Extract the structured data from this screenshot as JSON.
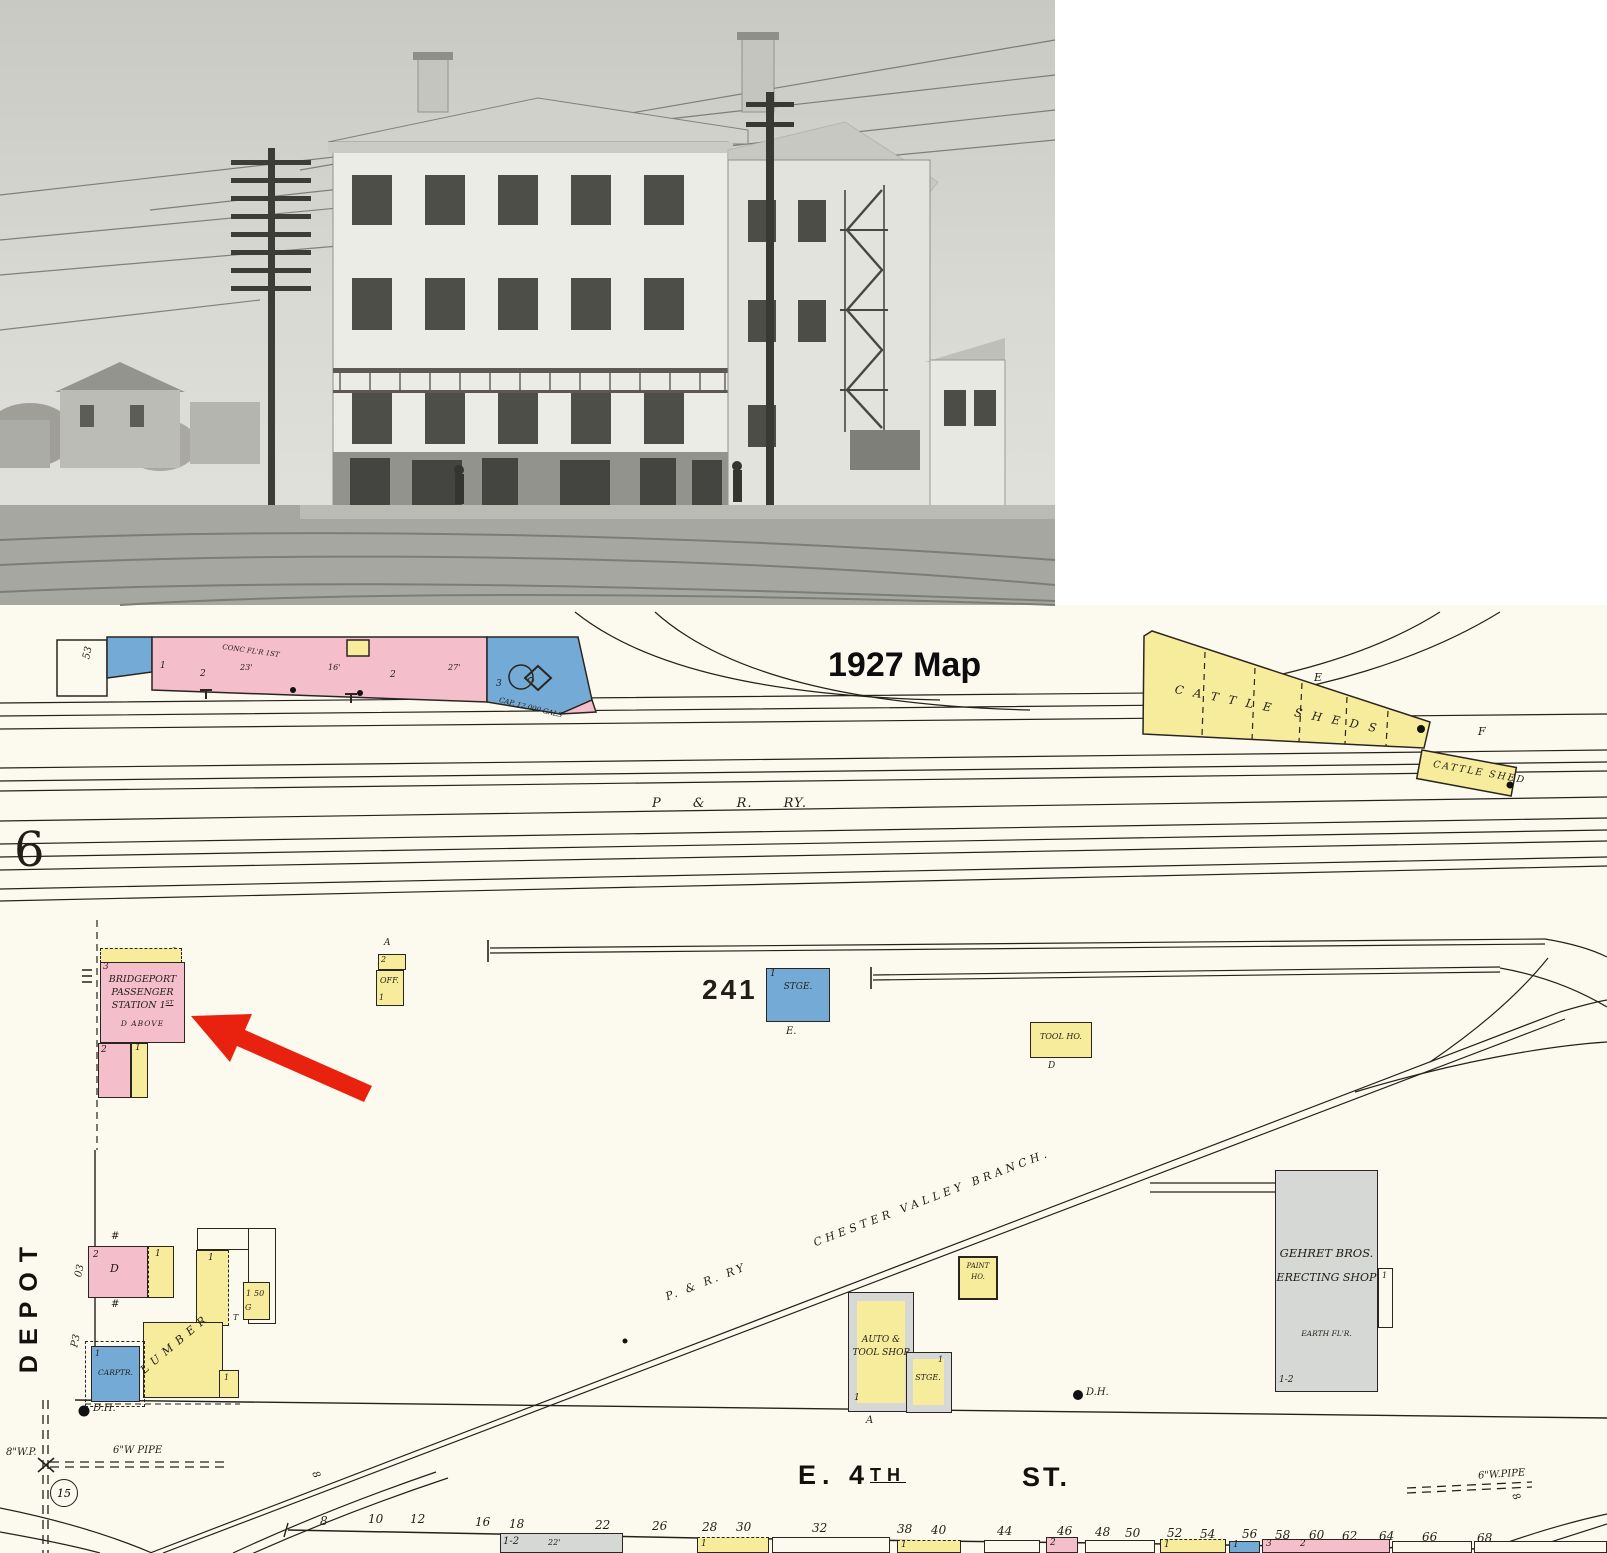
{
  "title": "1927 Map",
  "page_no": "6",
  "yard": {
    "main_line": "P & R. RY."
  },
  "branch": {
    "prefix": "P. & R. RY",
    "name": "CHESTER VALLEY BRANCH."
  },
  "cattle": {
    "big": "CATTLE SHEDS.",
    "e": "E",
    "small": "CATTLE SHED",
    "f": "F"
  },
  "strip": {
    "no53": "53",
    "n1": "1",
    "conc": "CONC FL'R 1ST",
    "w23": "23'",
    "sw1": "2",
    "w16": "16'",
    "sw2": "2",
    "w27": "27'",
    "n3": "3",
    "tank": "CAP. 12,000 GALS"
  },
  "station": {
    "no3": "3",
    "l1": "BRIDGEPORT",
    "l2": "PASSENGER",
    "l3": "STATION 1",
    "l3sup": "ST",
    "l4": "D ABOVE",
    "no2": "2",
    "no1": "1"
  },
  "office": {
    "a": "A",
    "n2": "2",
    "label": "OFF.",
    "n1": "1"
  },
  "lot241": "241",
  "stge": {
    "n1": "1",
    "label": "STGE.",
    "e": "E."
  },
  "toolho": {
    "label": "TOOL HO.",
    "d": "D"
  },
  "paintho": {
    "l1": "PAINT",
    "l2": "HO."
  },
  "gehret": {
    "l1": "GEHRET BROS.",
    "l2": "ERECTING SHOP",
    "l3": "EARTH FL'R.",
    "annex_n": "1",
    "floors": "1-2"
  },
  "autoshop": {
    "l1": "AUTO &",
    "l2": "TOOL SHOP",
    "n1": "1",
    "stge_label": "STGE.",
    "stge_n": "1",
    "a": "A"
  },
  "depot": {
    "street": "DEPOT",
    "no03": "03",
    "noP3": "P3",
    "d_floors": "2",
    "d": "D",
    "hash": "#",
    "y1_n": "1",
    "w_n": "1",
    "y2_n": "1",
    "y2_50": "50",
    "t": "T",
    "g": "G",
    "carptr": "CARPTR.",
    "carptr_n": "1",
    "lumber": "LUMBER",
    "y3_n": "1",
    "dh": "D.H."
  },
  "pipes": {
    "wp8": "8\"W.P.",
    "wpipe6": "6\"W PIPE",
    "valve": "15",
    "dh_right": "D.H.",
    "wpipe6_right": "6\"W.PIPE",
    "mark8": "8"
  },
  "street4": {
    "e4": "E. 4",
    "e4sup": "TH",
    "st": "ST."
  },
  "lots": [
    "8",
    "10",
    "12",
    "16",
    "18",
    "22",
    "26",
    "28",
    "30",
    "32",
    "38",
    "40",
    "44",
    "46",
    "48",
    "50",
    "52",
    "54",
    "56",
    "58",
    "60",
    "62",
    "64",
    "66",
    "68"
  ],
  "bottom": {
    "gray_n": "1-2",
    "gray_w": "22'",
    "b1_n": "1",
    "b2_n": "1",
    "pink_n": "2",
    "y3_n": "1",
    "blue_n": "1",
    "pink2_a": "3",
    "pink2_b": "2"
  }
}
